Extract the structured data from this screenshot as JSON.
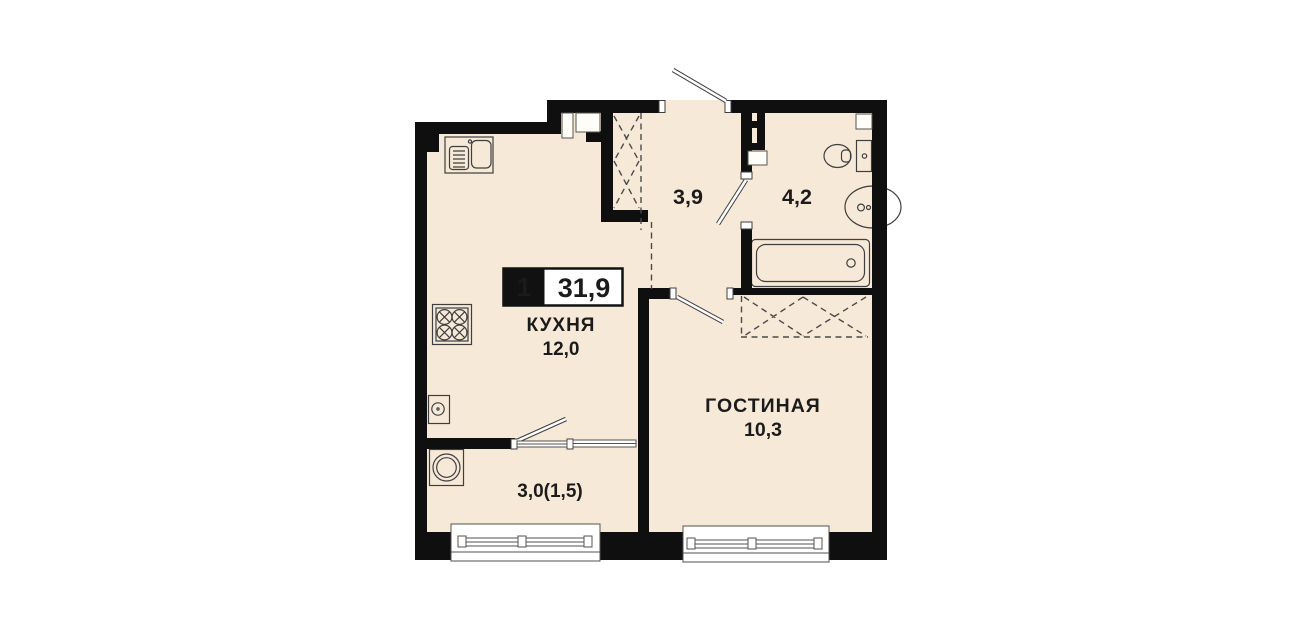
{
  "plan": {
    "badge": {
      "rooms": "1",
      "total_area": "31,9"
    },
    "rooms": {
      "kitchen": {
        "label": "КУХНЯ",
        "area": "12,0"
      },
      "hallway": {
        "area": "3,9"
      },
      "bathroom": {
        "area": "4,2"
      },
      "living_room": {
        "label": "ГОСТИНАЯ",
        "area": "10,3"
      },
      "balcony": {
        "area": "3,0(1,5)"
      }
    },
    "fixtures": [
      "kitchen-sink",
      "stove",
      "water-heater",
      "washing-machine",
      "toilet",
      "bathroom-sink",
      "bathtub",
      "wardrobe-dashed-zones",
      "entrance-door",
      "interior-doors",
      "balcony-door-window",
      "facade-windows"
    ],
    "colors": {
      "background": "#ffffff",
      "floor": "#f7e9d8",
      "wall": "#0f0f0f",
      "outline": "#3f3f3f",
      "text": "#1b1b1b"
    }
  }
}
